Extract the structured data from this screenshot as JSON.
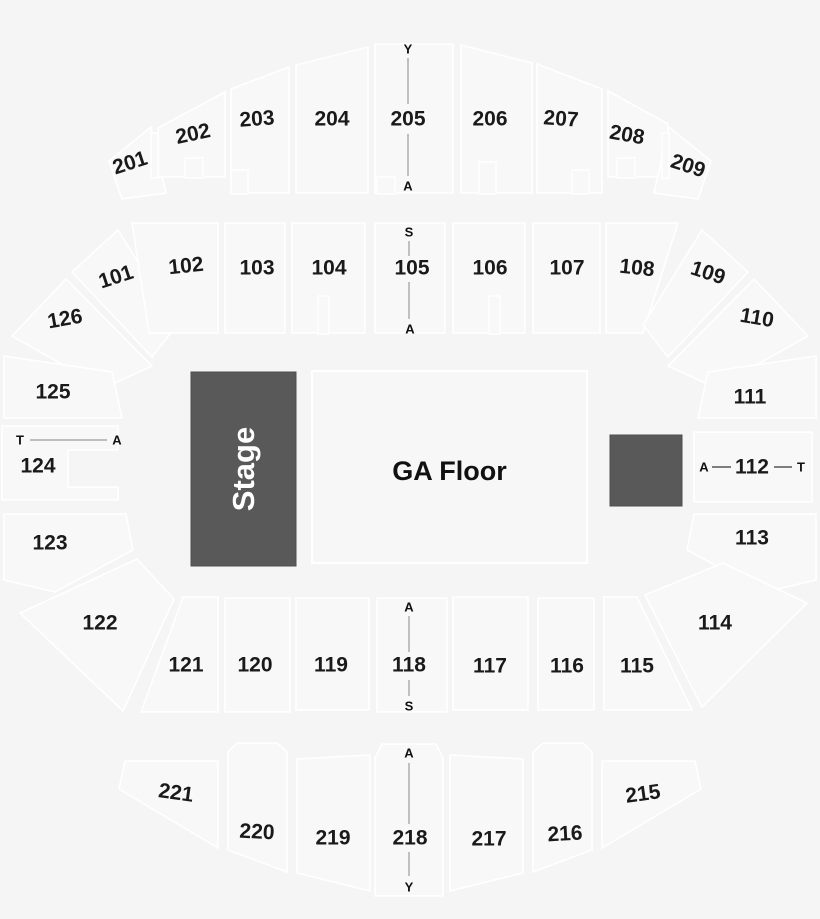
{
  "colors": {
    "background": "#f5f5f5",
    "section_fill": "#f8f8f8",
    "section_stroke": "#ffffff",
    "dark_fill": "#595959",
    "label_color": "#1a1a1a",
    "range_line_color": "#9a9a9a"
  },
  "stage": {
    "label": "Stage"
  },
  "floor": {
    "label": "GA Floor"
  },
  "blocks": {
    "stage": {
      "x": 191,
      "y": 372,
      "w": 105,
      "h": 194
    },
    "floor": {
      "x": 312,
      "y": 371,
      "w": 275,
      "h": 192
    },
    "dark_square": {
      "x": 610,
      "y": 435,
      "w": 72,
      "h": 71
    }
  },
  "sections": [
    {
      "label": "201",
      "shape": "M109,161 L151,127 L166,193 L122,199 Z",
      "lx": 130,
      "ly": 163,
      "rot": -18
    },
    {
      "label": "202",
      "shape": "M158,128 L225,92 L225,177 L158,177 Z",
      "lx": 193,
      "ly": 134,
      "rot": -12
    },
    {
      "label": "203",
      "shape": "M231,89 L289,67 L289,193 L231,193 Z",
      "lx": 257,
      "ly": 119,
      "rot": -4
    },
    {
      "label": "204",
      "shape": "M296,65 L368,47 L368,193 L296,193 Z",
      "lx": 332,
      "ly": 119,
      "rot": 0
    },
    {
      "label": "205",
      "shape": "M375,44 L453,44 L453,193 L375,193 Z",
      "lx": 408,
      "ly": 119,
      "rot": 0
    },
    {
      "label": "206",
      "shape": "M461,45 L532,63 L532,193 L461,193 Z",
      "lx": 490,
      "ly": 119,
      "rot": 0
    },
    {
      "label": "207",
      "shape": "M537,64 L602,89 L602,193 L537,193 Z",
      "lx": 561,
      "ly": 119,
      "rot": 4
    },
    {
      "label": "208",
      "shape": "M608,91 L668,124 L668,177 L608,177 Z",
      "lx": 627,
      "ly": 135,
      "rot": 10
    },
    {
      "label": "209",
      "shape": "M669,127 L711,161 L698,199 L654,193 Z",
      "lx": 688,
      "ly": 166,
      "rot": 18
    },
    {
      "label": "101",
      "shape": "M72,272 L118,230 L177,325 L152,357 Z",
      "lx": 116,
      "ly": 277,
      "rot": -18
    },
    {
      "label": "102",
      "shape": "M132,223 L218,223 L218,333 L149,333 Z",
      "lx": 186,
      "ly": 266,
      "rot": -6
    },
    {
      "label": "103",
      "shape": "M225,223 L285,223 L285,333 L225,333 Z",
      "lx": 257,
      "ly": 268,
      "rot": 0
    },
    {
      "label": "104",
      "shape": "M292,223 L365,223 L365,333 L292,333 Z",
      "lx": 329,
      "ly": 268,
      "rot": 0
    },
    {
      "label": "105",
      "shape": "M375,223 L445,223 L445,333 L375,333 Z",
      "lx": 412,
      "ly": 268,
      "rot": 0
    },
    {
      "label": "106",
      "shape": "M453,223 L525,223 L525,333 L453,333 Z",
      "lx": 490,
      "ly": 268,
      "rot": 0
    },
    {
      "label": "107",
      "shape": "M533,223 L600,223 L600,333 L533,333 Z",
      "lx": 567,
      "ly": 268,
      "rot": 0
    },
    {
      "label": "108",
      "shape": "M606,223 L678,223 L643,333 L606,333 Z",
      "lx": 637,
      "ly": 268,
      "rot": 6
    },
    {
      "label": "109",
      "shape": "M702,230 L748,272 L668,357 L643,325 Z",
      "lx": 708,
      "ly": 273,
      "rot": 18
    },
    {
      "label": "110",
      "shape": "M754,279 L808,336 L716,388 L668,366 Z",
      "lx": 757,
      "ly": 318,
      "rot": 10
    },
    {
      "label": "126",
      "shape": "M12,336 L66,279 L152,366 L104,388 Z",
      "lx": 65,
      "ly": 319,
      "rot": -10
    },
    {
      "label": "125",
      "shape": "M4,356 L112,372 L122,418 L4,418 Z",
      "lx": 53,
      "ly": 392,
      "rot": 0
    },
    {
      "label": "124",
      "shape": "M2,426 L118,426 L118,450 L68,450 L68,487 L118,487 L118,500 L2,500 Z",
      "lx": 38,
      "ly": 466,
      "rot": 0
    },
    {
      "label": "123",
      "shape": "M4,514 L126,514 L133,550 L55,592 L4,580 Z",
      "lx": 50,
      "ly": 543,
      "rot": 0
    },
    {
      "label": "122",
      "shape": "M20,613 L137,559 L174,599 L123,711 Z",
      "lx": 100,
      "ly": 623,
      "rot": 0
    },
    {
      "label": "111",
      "shape": "M816,356 L708,372 L698,418 L816,418 Z",
      "lx": 750,
      "ly": 397,
      "rot": 0
    },
    {
      "label": "112",
      "shape": "M694,432 L812,432 L812,502 L694,502 Z",
      "lx": 752,
      "ly": 467,
      "rot": 0
    },
    {
      "label": "113",
      "shape": "M816,514 L694,514 L687,550 L765,592 L816,580 Z",
      "lx": 752,
      "ly": 538,
      "rot": 0
    },
    {
      "label": "114",
      "shape": "M645,595 L723,563 L807,603 L702,707 Z",
      "lx": 715,
      "ly": 623,
      "rot": 0
    },
    {
      "label": "121",
      "shape": "M183,597 L218,597 L218,712 L141,712 Z",
      "lx": 186,
      "ly": 665,
      "rot": 0
    },
    {
      "label": "120",
      "shape": "M225,598 L290,598 L290,712 L225,712 Z",
      "lx": 255,
      "ly": 665,
      "rot": 0
    },
    {
      "label": "119",
      "shape": "M296,598 L369,598 L369,710 L296,710 Z",
      "lx": 331,
      "ly": 665,
      "rot": 0
    },
    {
      "label": "118",
      "shape": "M377,598 L447,598 L447,712 L377,712 Z",
      "lx": 409,
      "ly": 665,
      "rot": 0
    },
    {
      "label": "117",
      "shape": "M453,597 L528,597 L528,710 L453,710 Z",
      "lx": 490,
      "ly": 666,
      "rot": 0
    },
    {
      "label": "116",
      "shape": "M538,598 L594,598 L594,710 L538,710 Z",
      "lx": 567,
      "ly": 666,
      "rot": 0
    },
    {
      "label": "115",
      "shape": "M604,597 L637,597 L692,710 L604,710 Z",
      "lx": 637,
      "ly": 666,
      "rot": 0
    },
    {
      "label": "221",
      "shape": "M125,761 L218,761 L218,848 L119,789 Z",
      "lx": 176,
      "ly": 793,
      "rot": 8
    },
    {
      "label": "220",
      "shape": "M228,752 L237,743 L277,743 L287,752 L287,872 L228,850 Z",
      "lx": 257,
      "ly": 832,
      "rot": 3
    },
    {
      "label": "219",
      "shape": "M297,759 L370,755 L370,891 L297,873 Z",
      "lx": 333,
      "ly": 838,
      "rot": 0
    },
    {
      "label": "218",
      "shape": "M375,758 L382,744 L436,744 L443,758 L443,896 L375,896 Z",
      "lx": 410,
      "ly": 838,
      "rot": 0
    },
    {
      "label": "217",
      "shape": "M450,755 L523,759 L523,873 L450,891 Z",
      "lx": 489,
      "ly": 839,
      "rot": 0
    },
    {
      "label": "216",
      "shape": "M533,752 L543,743 L583,743 L592,752 L592,850 L533,872 Z",
      "lx": 565,
      "ly": 834,
      "rot": -3
    },
    {
      "label": "215",
      "shape": "M602,761 L695,761 L701,789 L602,848 Z",
      "lx": 643,
      "ly": 794,
      "rot": -8
    }
  ],
  "row_markers": [
    {
      "text": "Y",
      "x": 408,
      "y": 49
    },
    {
      "text": "A",
      "x": 408,
      "y": 186
    },
    {
      "text": "S",
      "x": 409,
      "y": 232
    },
    {
      "text": "A",
      "x": 410,
      "y": 329
    },
    {
      "text": "T",
      "x": 20,
      "y": 440
    },
    {
      "text": "A",
      "x": 117,
      "y": 440
    },
    {
      "text": "A",
      "x": 704,
      "y": 467
    },
    {
      "text": "T",
      "x": 801,
      "y": 467
    },
    {
      "text": "A",
      "x": 409,
      "y": 607
    },
    {
      "text": "S",
      "x": 409,
      "y": 706
    },
    {
      "text": "A",
      "x": 409,
      "y": 753
    },
    {
      "text": "Y",
      "x": 409,
      "y": 887
    }
  ],
  "range_lines": [
    {
      "x1": 408,
      "y1": 58,
      "x2": 408,
      "y2": 104,
      "style": "range"
    },
    {
      "x1": 408,
      "y1": 134,
      "x2": 408,
      "y2": 176,
      "style": "range"
    },
    {
      "x1": 409,
      "y1": 241,
      "x2": 409,
      "y2": 256,
      "style": "range"
    },
    {
      "x1": 409,
      "y1": 282,
      "x2": 409,
      "y2": 319,
      "style": "range"
    },
    {
      "x1": 409,
      "y1": 616,
      "x2": 409,
      "y2": 652,
      "style": "range"
    },
    {
      "x1": 409,
      "y1": 680,
      "x2": 409,
      "y2": 696,
      "style": "range"
    },
    {
      "x1": 409,
      "y1": 763,
      "x2": 409,
      "y2": 824,
      "style": "range"
    },
    {
      "x1": 409,
      "y1": 852,
      "x2": 409,
      "y2": 876,
      "style": "range"
    },
    {
      "x1": 30,
      "y1": 440,
      "x2": 107,
      "y2": 440,
      "style": "range"
    },
    {
      "x1": 712,
      "y1": 467,
      "x2": 731,
      "y2": 467,
      "style": "dash"
    },
    {
      "x1": 774,
      "y1": 467,
      "x2": 792,
      "y2": 467,
      "style": "dash"
    }
  ],
  "notches": [
    {
      "x": 185,
      "y": 158,
      "w": 18,
      "h": 20
    },
    {
      "x": 231,
      "y": 170,
      "w": 17,
      "h": 24
    },
    {
      "x": 377,
      "y": 177,
      "w": 18,
      "h": 17
    },
    {
      "x": 479,
      "y": 162,
      "w": 17,
      "h": 32
    },
    {
      "x": 572,
      "y": 170,
      "w": 17,
      "h": 24
    },
    {
      "x": 617,
      "y": 158,
      "w": 18,
      "h": 20
    },
    {
      "x": 151,
      "y": 133,
      "w": 7,
      "h": 45
    },
    {
      "x": 662,
      "y": 133,
      "w": 7,
      "h": 45
    },
    {
      "x": 318,
      "y": 296,
      "w": 11,
      "h": 38
    },
    {
      "x": 489,
      "y": 296,
      "w": 11,
      "h": 38
    }
  ]
}
